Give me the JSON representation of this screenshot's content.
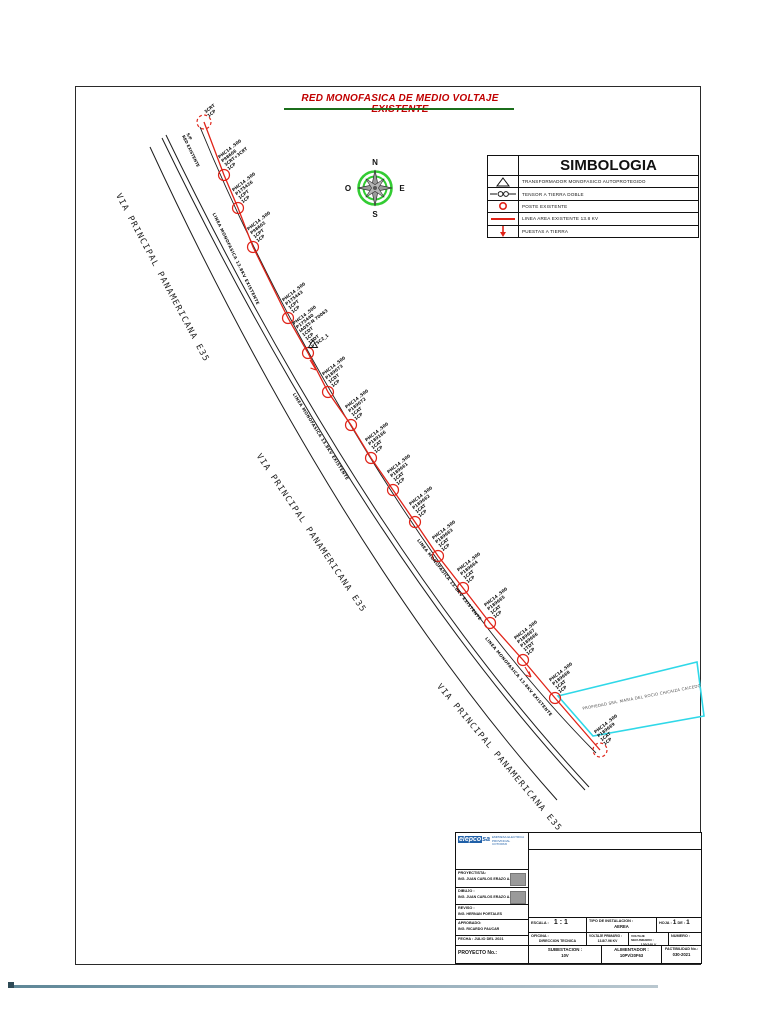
{
  "title": "RED MONOFASICA DE MEDIO VOLTAJE EXISTENTE",
  "compass": {
    "n": "N",
    "s": "S",
    "e": "E",
    "o": "O"
  },
  "colors": {
    "line_red": "#e02318",
    "road_black": "#1c1c1c",
    "cyan": "#2fd8e8",
    "green_ring": "#33cc33",
    "title_red": "#c00000",
    "underline_green": "#1b6e1b",
    "logo_blue": "#2060a8"
  },
  "legend": {
    "title": "SIMBOLOGIA",
    "rows": [
      {
        "symbol": "transformer-triangle-icon",
        "label": "TRANSFORMADOR MONOFASICO AUTOPROTEGIDO"
      },
      {
        "symbol": "tensor-icon",
        "label": "TENSOR A TIERRA DOBLE"
      },
      {
        "symbol": "pole-circle-icon",
        "label": "POSTE EXISTENTE"
      },
      {
        "symbol": "red-line-icon",
        "label": "LINEA AREA EXISTENTE 13.8 KV"
      },
      {
        "symbol": "ground-arrow-icon",
        "label": "PUESTAS A TIERRA"
      }
    ]
  },
  "road": {
    "label": "VIA PRINCIPAL PANAMERICANA E35",
    "labels": [
      {
        "x": 122,
        "y": 192,
        "rot": 62
      },
      {
        "x": 262,
        "y": 452,
        "rot": 56
      },
      {
        "x": 442,
        "y": 682,
        "rot": 50
      }
    ]
  },
  "line_label": "LINEA MONOFASICA 13.8KV EXISTENTE",
  "line_labels": [
    {
      "x": 216,
      "y": 212,
      "rot": 64
    },
    {
      "x": 296,
      "y": 392,
      "rot": 58
    },
    {
      "x": 420,
      "y": 538,
      "rot": 52
    },
    {
      "x": 488,
      "y": 636,
      "rot": 50
    }
  ],
  "start_note": {
    "text": "S/P\nRED EXISTENTE",
    "x": 190,
    "y": 132,
    "rot": 64
  },
  "poles": [
    {
      "x": 204,
      "y": 122,
      "label": "3CRT\n1CP",
      "dashed": true
    },
    {
      "x": 224,
      "y": 175,
      "label": "PHC14 .500\nP98606\n3CRT+3CRT\n1CP"
    },
    {
      "x": 238,
      "y": 208,
      "label": "PHC14 .500\nP175426\n1CPT\n1CP"
    },
    {
      "x": 253,
      "y": 247,
      "label": "PHC14 .500\nP98602\n1CPT\n1CP"
    },
    {
      "x": 288,
      "y": 318,
      "label": "PHC14 .500\nP175443\n1CPT\n1CP"
    },
    {
      "x": 308,
      "y": 353,
      "label": "PHC14 .500\nP175440\nIA05T-N 70063\n1CDT\n1CP\n1TDT\nPT5C2_1",
      "transformer": true,
      "ground": true
    },
    {
      "x": 328,
      "y": 392,
      "label": "PHC14 .500\nP189073\n1CDT\n1CP"
    },
    {
      "x": 351,
      "y": 425,
      "label": "PHC14 .500\nP189072\n1CAT\n1CP"
    },
    {
      "x": 371,
      "y": 458,
      "label": "PHC14 .500\nP189166\n1CAT\n1CP"
    },
    {
      "x": 393,
      "y": 490,
      "label": "PHC14 .500\nP189661\n1CAT\n1CP"
    },
    {
      "x": 415,
      "y": 522,
      "label": "PHC14 .500\nP189662\n1CAT\n1CP"
    },
    {
      "x": 438,
      "y": 556,
      "label": "PHC14 .500\nP189663\n1CAT\n1CP"
    },
    {
      "x": 463,
      "y": 588,
      "label": "PHC14 .500\nP189664\n1CAT\n1CP"
    },
    {
      "x": 490,
      "y": 623,
      "label": "PHC14 .500\nP189665\n1CAT\n1CP"
    },
    {
      "x": 523,
      "y": 660,
      "label": "PHC14 .500\nP189667\nP189666\n1TDT\n1CP",
      "ground": true
    },
    {
      "x": 555,
      "y": 698,
      "label": "PHC14 .500\nP189668\n1CAT\n1CP"
    },
    {
      "x": 600,
      "y": 750,
      "label": "PHC14 .500\nP189669\n1CAT\n1CP",
      "dashed": true
    }
  ],
  "property": {
    "label": "PROPIEDAD SRA. MARIA DEL ROCIO CHICAIZA CAICEDO",
    "points": [
      [
        558,
        696
      ],
      [
        697,
        662
      ],
      [
        704,
        716
      ],
      [
        593,
        736
      ]
    ],
    "text_x": 582,
    "text_y": 706,
    "text_rot": -11
  },
  "titleblock": {
    "logo_name": "elepco",
    "logo_suffix": "sa",
    "logo_side": "EMPRESA ELECTRICA\nPROVINCIAL COTOPAXI",
    "proyectista_label": "PROYECTISTA:",
    "proyectista_value": "ING. JUAN CARLOS ERAZO A.",
    "dibujo_label": "DIBUJO :",
    "dibujo_value": "ING. JUAN CARLOS ERAZO A.",
    "reviso_label": "REVISO :",
    "reviso_value": "ING. HERNAN PORTALES",
    "aprobado_label": "APROBADO:",
    "aprobado_value": "ING. RICARDO PAUCAR",
    "fecha_label": "FECHA :",
    "fecha_value": "JULIO DEL 2021",
    "proyecto_label": "PROYECTO No.:",
    "escala_label": "ESCALA :",
    "escala_value": "1 : 1",
    "tipo_label": "TIPO DE INSTALACION :",
    "tipo_value": "AEREA",
    "hoja_label": "HOJA :",
    "hoja_value": "1",
    "de_label": "DE :",
    "de_value": "1",
    "oficina_label": "OFICINA :",
    "oficina_value": "DIRECCION TECNICA",
    "vprim_label": "VOLTAJE PRIMARIO :",
    "vprim_value": "13.8/7.96 KV",
    "vsec_label": "VOLTAJE SECUNDARIO :",
    "vsec_value": "120/240 V",
    "numero_label": "NUMERO :",
    "subestacion_label": "SUBESTACION :",
    "subestacion_value": "10V",
    "alimentador_label": "ALIMENTADOR :",
    "alimentador_value": "10PV/20F63",
    "factibilidad_label": "FACTIBILIDAD No.:",
    "factibilidad_value": "030-2021"
  }
}
